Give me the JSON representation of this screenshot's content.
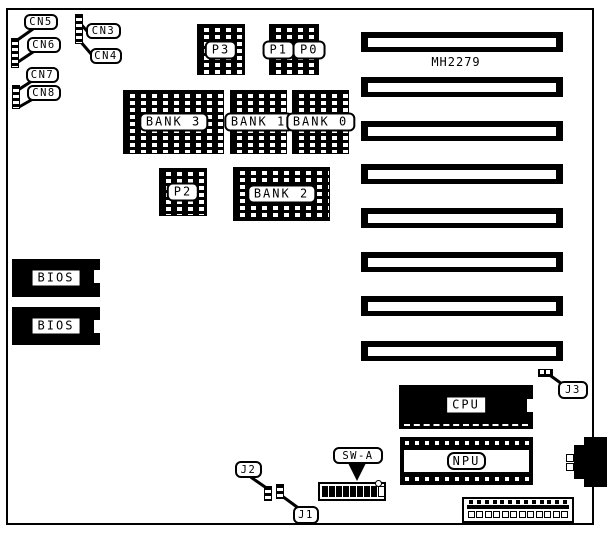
{
  "colors": {
    "ink": "#000000",
    "paper": "#ffffff"
  },
  "silkscreen": {
    "part_number": "MH2279"
  },
  "callouts": {
    "cn3": "CN3",
    "cn4": "CN4",
    "cn5": "CN5",
    "cn6": "CN6",
    "cn7": "CN7",
    "cn8": "CN8",
    "j1": "J1",
    "j2": "J2",
    "j3": "J3",
    "swa": "SW-A"
  },
  "chips": {
    "p3": "P3",
    "p1": "P1",
    "p0": "P0",
    "p2": "P2",
    "bank3": "BANK 3",
    "bank1": "BANK 1",
    "bank0": "BANK 0",
    "bank2": "BANK 2",
    "bios_top": "BIOS",
    "bios_bottom": "BIOS",
    "cpu": "CPU",
    "npu": "NPU"
  },
  "expansion_slots": {
    "count": 8
  },
  "dip_switch": {
    "segments": 9,
    "filled_segments": 8
  },
  "power_connector": {
    "pin_count": 13,
    "pad_count": 12
  }
}
